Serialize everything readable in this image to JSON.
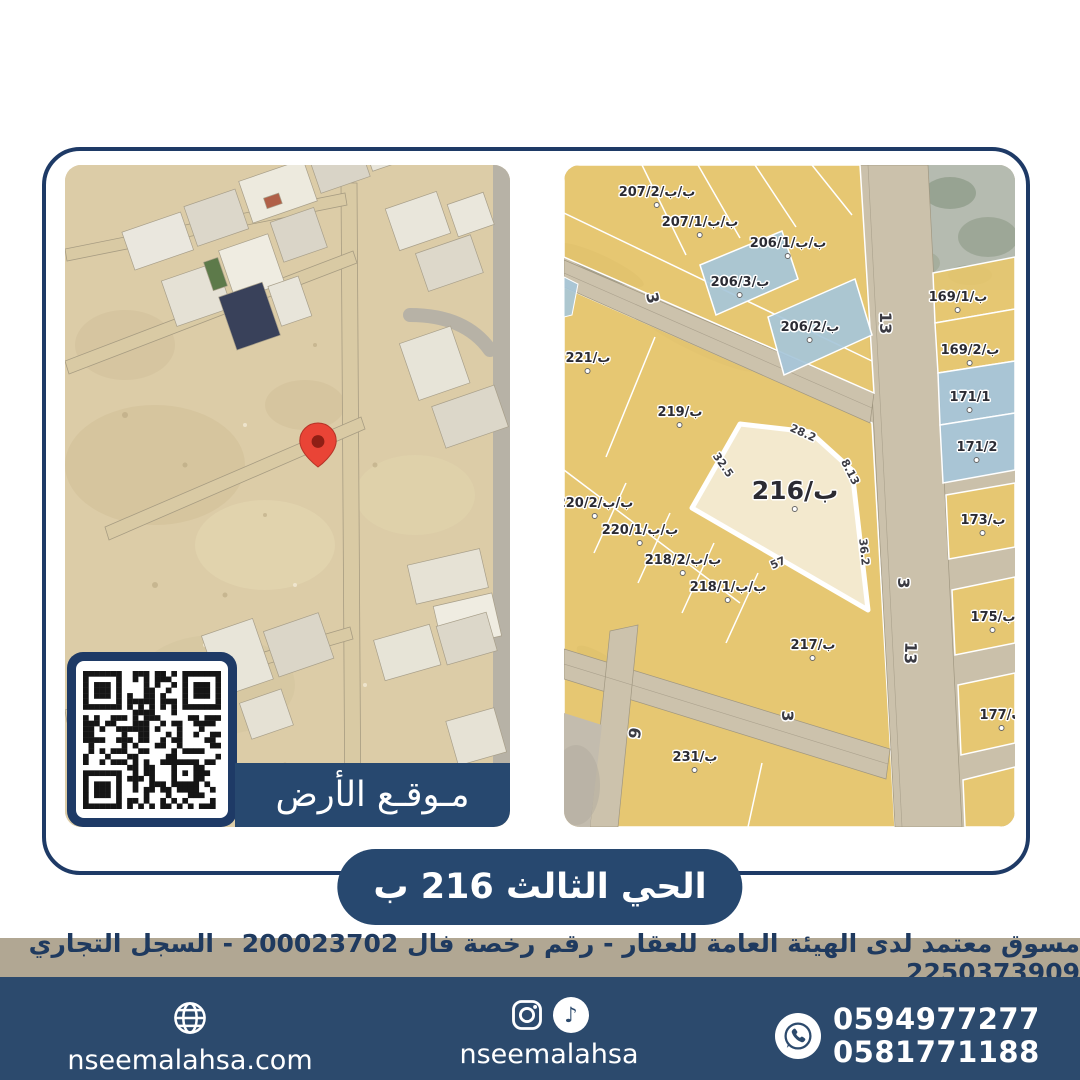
{
  "banner": {
    "text": "الحي الثالث 216 ب"
  },
  "left_map": {
    "location_label": "مـوقـع الأرض",
    "marker": "red-location-pin",
    "qr": "qr-code"
  },
  "right_map": {
    "highlight_parcel": "ب/216",
    "labels": [
      {
        "t": "ب/ب/207/2",
        "x": 93,
        "y": 32
      },
      {
        "t": "ب/ب/207/1",
        "x": 136,
        "y": 62
      },
      {
        "t": "ب/ب/206/1",
        "x": 224,
        "y": 83
      },
      {
        "t": "ب/206/3",
        "x": 176,
        "y": 122
      },
      {
        "t": "ب/206/2",
        "x": 246,
        "y": 167
      },
      {
        "t": "ب/221",
        "x": 24,
        "y": 198
      },
      {
        "t": "ب/219",
        "x": 116,
        "y": 252
      },
      {
        "t": "ب/ب/220/2",
        "x": 31,
        "y": 343
      },
      {
        "t": "ب/ب/220/1",
        "x": 76,
        "y": 370
      },
      {
        "t": "ب/ب/218/2",
        "x": 119,
        "y": 400
      },
      {
        "t": "ب/ب/218/1",
        "x": 164,
        "y": 427
      },
      {
        "t": "ب/217",
        "x": 249,
        "y": 485
      },
      {
        "t": "ب/231",
        "x": 131,
        "y": 597
      },
      {
        "t": "ب/169/1",
        "x": 394,
        "y": 137
      },
      {
        "t": "ب/169/2",
        "x": 406,
        "y": 190
      },
      {
        "t": "171/1",
        "x": 406,
        "y": 237
      },
      {
        "t": "171/2",
        "x": 413,
        "y": 287
      },
      {
        "t": "ب/173",
        "x": 419,
        "y": 360
      },
      {
        "t": "ب/175",
        "x": 429,
        "y": 457
      },
      {
        "t": "ب/177",
        "x": 438,
        "y": 555
      },
      {
        "t": "ب/216",
        "x": 231,
        "y": 330,
        "c": "b"
      },
      {
        "t": "28.2",
        "x": 239,
        "y": 268,
        "c": "d",
        "r": 24
      },
      {
        "t": "8.13",
        "x": 286,
        "y": 307,
        "c": "d",
        "r": 63
      },
      {
        "t": "36.2",
        "x": 300,
        "y": 387,
        "c": "d",
        "r": 84
      },
      {
        "t": "57",
        "x": 214,
        "y": 398,
        "c": "d",
        "r": -24
      },
      {
        "t": "32.5",
        "x": 159,
        "y": 300,
        "c": "d",
        "r": 55
      },
      {
        "t": "13",
        "x": 321,
        "y": 158,
        "c": "s",
        "r": 90
      },
      {
        "t": "3",
        "x": 339,
        "y": 418,
        "c": "s",
        "r": 90
      },
      {
        "t": "13",
        "x": 346,
        "y": 488,
        "c": "s",
        "r": 92
      },
      {
        "t": "3",
        "x": 88,
        "y": 133,
        "c": "s",
        "r": 78
      },
      {
        "t": "3",
        "x": 223,
        "y": 551,
        "c": "s",
        "r": 90
      },
      {
        "t": "6",
        "x": 70,
        "y": 568,
        "c": "s",
        "r": 100
      }
    ]
  },
  "license": {
    "text": "مسوق معتمد لدى الهيئة العامة للعقار - رقم رخصة فال 200023702 - السجل التجاري 2250373909"
  },
  "footer": {
    "website": {
      "label": "nseemalahsa.com",
      "icon": "globe-icon"
    },
    "social": {
      "label": "nseemalahsa",
      "icons": [
        "instagram-icon",
        "tiktok-icon"
      ]
    },
    "phones": {
      "line1": "0594977277",
      "line2": "0581771188",
      "icon": "whatsapp-icon"
    }
  },
  "colors": {
    "navy": "#27486f",
    "frame_navy": "#1e3a66",
    "strip_tan": "#b1a793",
    "parcel_yellow": "#e9c76a",
    "parcel_blue": "#a6c6d9",
    "highlight_cream": "#f3e9ce",
    "pin_red": "#e94436",
    "footer_navy": "#2c4a6d"
  }
}
